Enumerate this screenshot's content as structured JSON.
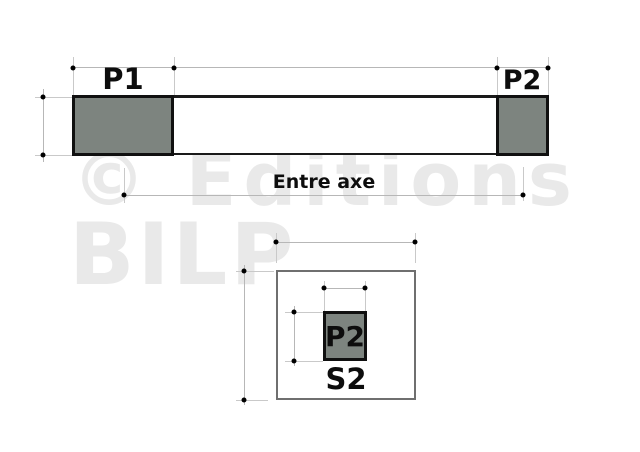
{
  "watermark": {
    "line1": "© Editions",
    "line2": "BILP"
  },
  "elevation_view": {
    "post1_label": "P1",
    "post2_label": "P2",
    "span_dimension_label": "Entre axe"
  },
  "section_view": {
    "post_label": "P2",
    "section_label": "S2"
  },
  "colors": {
    "post_fill": "#7d847f",
    "outline": "#101010",
    "beam_outline": "#1a1a1a",
    "dimension_line": "#b7b7b7",
    "extension_line": "#c9c9c9",
    "section_outline": "#6f6f6f",
    "watermark_text": "#e9e9e9",
    "background": "#ffffff"
  }
}
